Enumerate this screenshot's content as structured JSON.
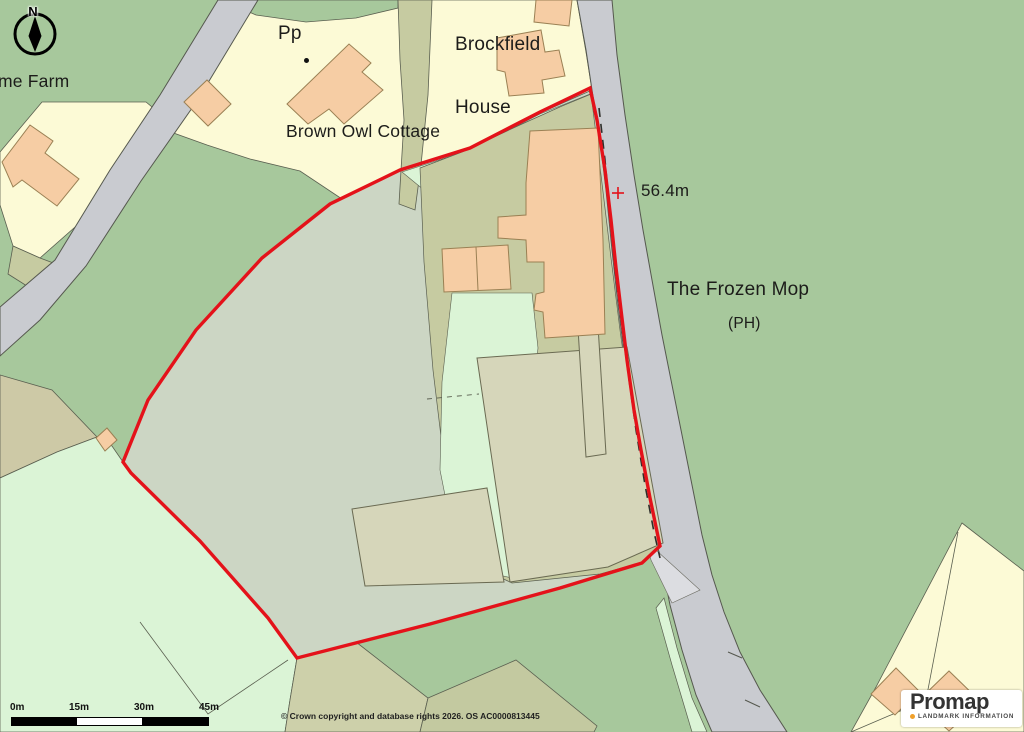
{
  "map": {
    "labels": {
      "farm": "me Farm",
      "pp": "Pp",
      "brown_owl": "Brown Owl Cottage",
      "brockfield_line1": "Brockfield",
      "brockfield_line2": "House",
      "spot_height": "56.4m",
      "pub_name": "The Frozen Mop",
      "pub_type": "(PH)"
    },
    "north_indicator": "N",
    "scale_bar": {
      "labels": [
        "0m",
        "15m",
        "30m",
        "45m"
      ]
    },
    "copyright": "© Crown copyright and database rights 2026. OS AC0000813445",
    "logo": {
      "brand": "Promap",
      "tagline": "LANDMARK INFORMATION"
    },
    "colors": {
      "site_boundary_red": "#e4121a",
      "background_green": "#a7c89c",
      "field_mint": "#dbf4d6",
      "site_sage": "#ccd6c4",
      "yard_khaki": "#c6cba1",
      "barn_khaki": "#d6d6ba",
      "parcel_cream": "#fcfad6",
      "building_peach": "#f6cda4",
      "road_grey": "#c9cbd0",
      "logo_orange": "#f0a02a"
    }
  }
}
